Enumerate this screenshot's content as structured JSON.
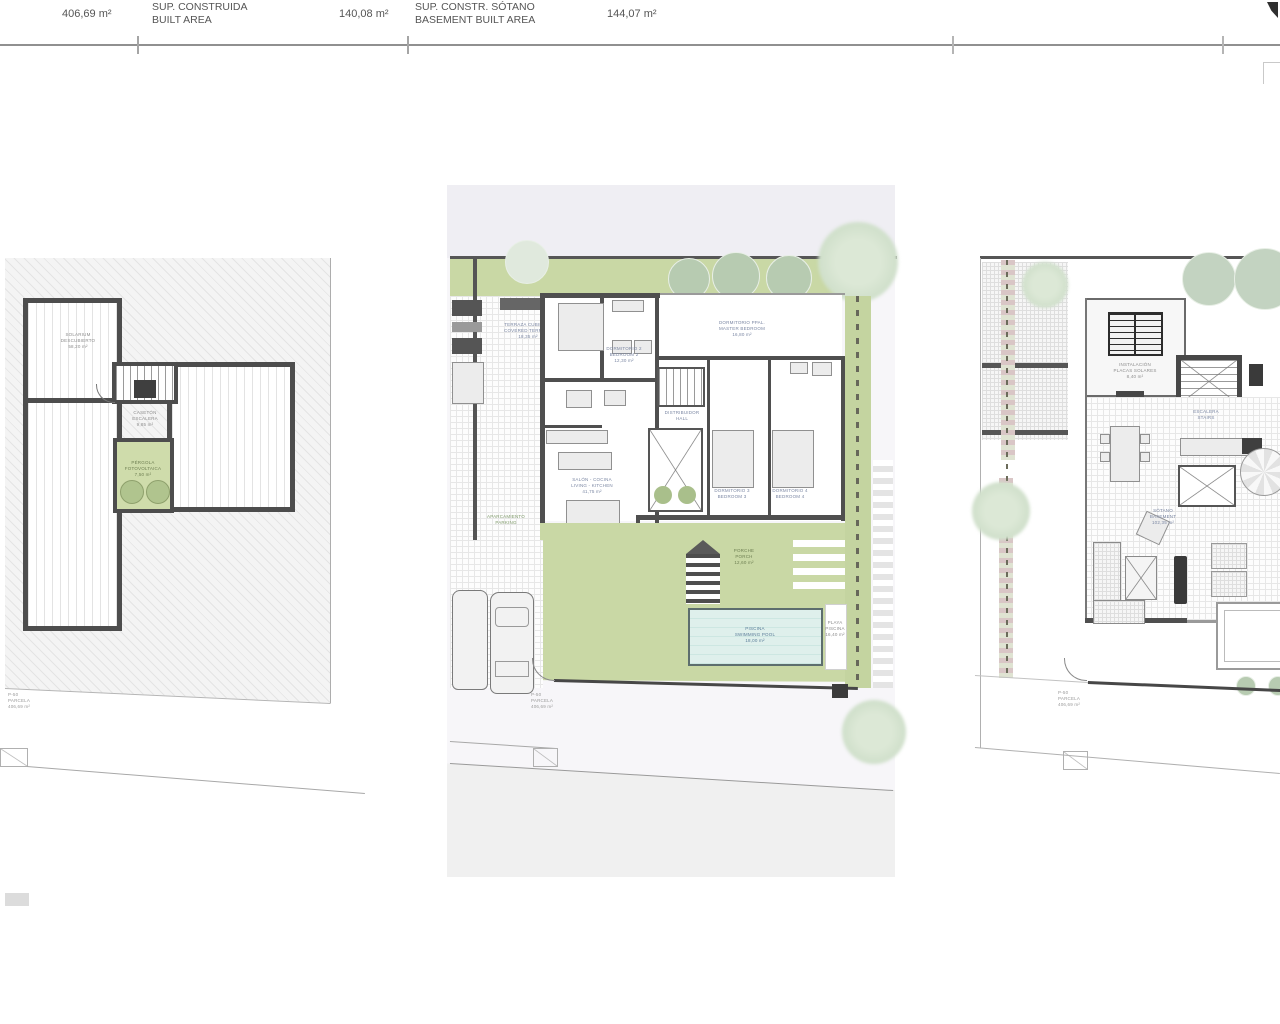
{
  "header": {
    "plot_area_value": "406,69 m²",
    "built_area_label_es": "SUP. CONSTRUIDA",
    "built_area_label_en": "BUILT AREA",
    "built_area_value": "140,08 m²",
    "basement_label_es": "SUP. CONSTR. SÓTANO",
    "basement_label_en": "BASEMENT BUILT AREA",
    "basement_value": "144,07 m²"
  },
  "left_plan": {
    "solarium_label": {
      "l1": "SOLARIUM",
      "l2": "DESCUBIERTO",
      "l3": "58,20 m²"
    },
    "stair_label": {
      "l1": "CASETÓN",
      "l2": "ESCALERA",
      "l3": "9,85 m²"
    },
    "planter_label": {
      "l1": "PÉRGOLA",
      "l2": "FOTOVOLTAICA",
      "l3": "7,50 m²"
    },
    "parcel_label": {
      "l1": "P-50",
      "l2": "PARCELA",
      "l3": "406,69 m²"
    }
  },
  "center_plan": {
    "terrace_label": {
      "l1": "TERRAZA CUBIERTA",
      "l2": "COVERED TERRACE",
      "l3": "18,35 m²"
    },
    "bedroom2_label": {
      "l1": "DORMITORIO 2",
      "l2": "BEDROOM 2",
      "l3": "12,30 m²"
    },
    "master_label": {
      "l1": "DORMITORIO PPAL.",
      "l2": "MASTER BEDROOM",
      "l3": "16,80 m²"
    },
    "bedroom3_label": {
      "l1": "DORMITORIO 3",
      "l2": "BEDROOM 3",
      "l3": "11,60 m²"
    },
    "bedroom4_label": {
      "l1": "DORMITORIO 4",
      "l2": "BEDROOM 4",
      "l3": "11,20 m²"
    },
    "living_label": {
      "l1": "SALÓN - COCINA",
      "l2": "LIVING - KITCHEN",
      "l3": "41,75 m²"
    },
    "hall_label": {
      "l1": "DISTRIBUIDOR",
      "l2": "HALL",
      "l3": "8,20 m²"
    },
    "porch_label": {
      "l1": "PORCHE",
      "l2": "PORCH",
      "l3": "12,60 m²"
    },
    "pool_label": {
      "l1": "PISCINA",
      "l2": "SWIMMING POOL",
      "l3": "18,00 m²"
    },
    "deck_label": {
      "l1": "PLAYA",
      "l2": "PISCINA",
      "l3": "16,40 m²"
    },
    "parking_label": {
      "l1": "APARCAMIENTO",
      "l2": "PARKING"
    },
    "parcel_label": {
      "l1": "P-50",
      "l2": "PARCELA",
      "l3": "406,69 m²"
    }
  },
  "right_plan": {
    "solar_label": {
      "l1": "INSTALACIÓN",
      "l2": "PLACAS SOLARES",
      "l3": "8,40 m²"
    },
    "stair_label": {
      "l1": "ESCALERA",
      "l2": "STAIRS"
    },
    "basement_label": {
      "l1": "SÓTANO",
      "l2": "BASEMENT",
      "l3": "102,35 m²"
    },
    "parcel_label": {
      "l1": "P-50",
      "l2": "PARCELA",
      "l3": "406,69 m²"
    }
  },
  "colors": {
    "garden_green": "#c9d8a5",
    "pool_blue": "#dff0ec",
    "wall_grey": "#4f4f4f",
    "panel_lavender": "#efeef3"
  }
}
